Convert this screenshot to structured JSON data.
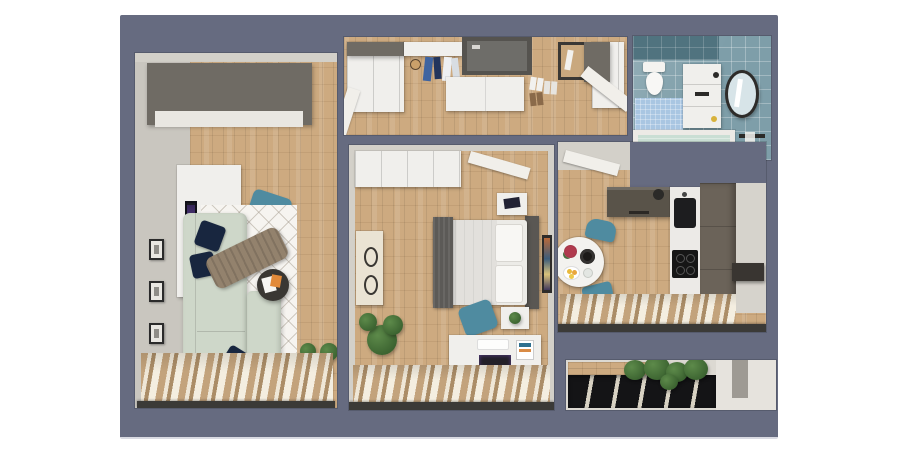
{
  "scene": {
    "kind": "apartment-floor-plan-3d-render",
    "view": "top-down",
    "background": "slate panel on white page",
    "text_visible": "none"
  },
  "colors": {
    "page_bg": "#ffffff",
    "board_bg": "#666b80",
    "board_edge": "#d9dae2",
    "wall": "#d3d0c9",
    "wall_light": "#c9c6bf",
    "wood": "#cdaa80",
    "wood_dark": "#b8926a",
    "white_furniture": "#f0efec",
    "dark_cabinet": "#6f6b64",
    "sofa": "#ced7c9",
    "navy": "#18263f",
    "throw": "#93826d",
    "rug": "#f6f4f0",
    "teal": "#4f8ba0",
    "tile": "#7e9ea9",
    "tile_dark": "#50737f",
    "mat_blue": "#a9c6e2",
    "tub_water": "#c9ded4",
    "taupe": "#6b6359",
    "appliance": "#1d1d1f",
    "curtain_tan": "#c3a37c",
    "curtain_cream": "#efe7d7",
    "sill": "#3b3a37",
    "plant": "#3c6a33",
    "door_white": "#f1efea",
    "glazing": "#141416",
    "screen_purple": "#5a3f8a",
    "frame_dark": "#2b2b2b"
  },
  "rooms": [
    {
      "id": "living-room",
      "label": "Living room",
      "furniture": [
        "wardrobe",
        "desk",
        "monitor",
        "office-chair",
        "books",
        "wall-frames",
        "sofa",
        "cushions",
        "throw-blanket",
        "rug",
        "coffee-table",
        "magazines",
        "plant",
        "window-curtains"
      ]
    },
    {
      "id": "hallway",
      "label": "Hallway / entry",
      "furniture": [
        "left-wardrobe",
        "coat-rack",
        "hanging-clothes",
        "front-door",
        "shoe-bench",
        "shoes",
        "mirror",
        "right-wardrobe",
        "open-doors"
      ]
    },
    {
      "id": "bedroom",
      "label": "Bedroom",
      "furniture": [
        "wardrobe",
        "open-door",
        "dresser",
        "double-bed",
        "pillows",
        "dark-throw",
        "nightstand-top",
        "nightstand-bottom",
        "wall-art",
        "desk",
        "laptop",
        "desk-chair",
        "plant",
        "window-curtains"
      ]
    },
    {
      "id": "bathroom",
      "label": "Bathroom",
      "furniture": [
        "toilet",
        "bath-mat",
        "vanity-sink",
        "round-mirror",
        "bathtub",
        "towel-rail"
      ]
    },
    {
      "id": "kitchen",
      "label": "Kitchen / dining",
      "furniture": [
        "open-door",
        "wall-cabinet",
        "sink",
        "cooktop",
        "tall-cabinets",
        "wall-shelf",
        "dining-table",
        "table-setting",
        "flowers",
        "teal-chairs",
        "window-curtains"
      ]
    },
    {
      "id": "balcony",
      "label": "Balcony",
      "furniture": [
        "glazing-frames",
        "plants",
        "wood-deck"
      ]
    }
  ]
}
